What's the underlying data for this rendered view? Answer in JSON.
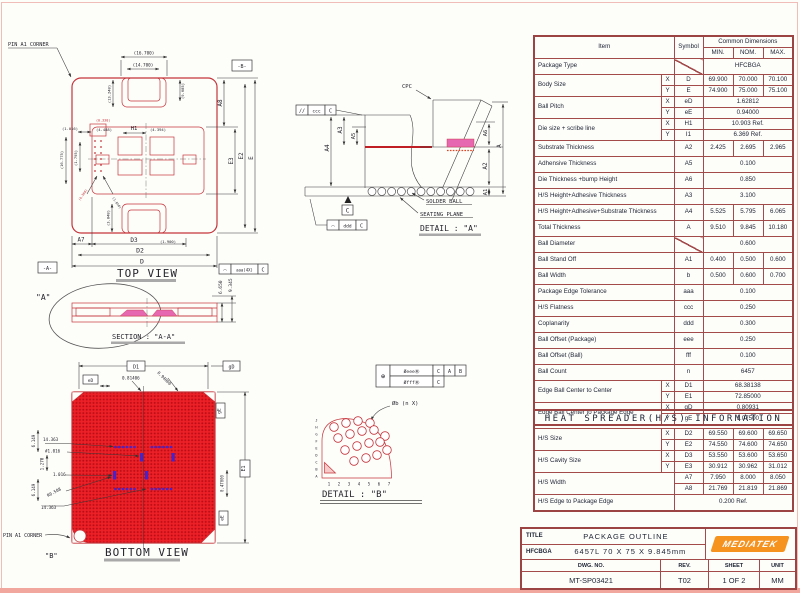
{
  "main_table": {
    "rows": [
      [
        {
          "t": "Item",
          "c": 2,
          "r": 2
        },
        {
          "t": "Symbol",
          "r": 2
        },
        {
          "t": "Common  Dimensions",
          "c": 3
        }
      ],
      [
        {
          "t": "MIN."
        },
        {
          "t": "NOM."
        },
        {
          "t": "MAX."
        }
      ],
      [
        {
          "t": "Package Type",
          "c": 2,
          "cls": "l s"
        },
        {
          "t": "",
          "cls": "diag"
        },
        {
          "t": "HFCBGA",
          "c": 3
        }
      ],
      [
        {
          "t": "Body Size",
          "c": 1,
          "r": 2,
          "cls": "l"
        },
        {
          "t": "X"
        },
        {
          "t": "D"
        },
        {
          "t": "69.900"
        },
        {
          "t": "70.000"
        },
        {
          "t": "70.100"
        }
      ],
      [
        {
          "t": "Y"
        },
        {
          "t": "E"
        },
        {
          "t": "74.900"
        },
        {
          "t": "75.000"
        },
        {
          "t": "75.100"
        }
      ],
      [
        {
          "t": "Ball Pitch",
          "r": 2,
          "cls": "l"
        },
        {
          "t": "X"
        },
        {
          "t": "eD"
        },
        {
          "t": "1.62812",
          "c": 3
        }
      ],
      [
        {
          "t": "Y"
        },
        {
          "t": "eE"
        },
        {
          "t": "0.94000",
          "c": 3
        }
      ],
      [
        {
          "t": "Die size + scribe line",
          "r": 2,
          "cls": "l"
        },
        {
          "t": "X"
        },
        {
          "t": "H1"
        },
        {
          "t": "10.903 Ref.",
          "c": 3
        }
      ],
      [
        {
          "t": "Y"
        },
        {
          "t": "I1"
        },
        {
          "t": "6.369 Ref.",
          "c": 3
        }
      ],
      [
        {
          "t": "Substrate Thickness",
          "c": 2,
          "cls": "l s"
        },
        {
          "t": "A2"
        },
        {
          "t": "2.425"
        },
        {
          "t": "2.695"
        },
        {
          "t": "2.965"
        }
      ],
      [
        {
          "t": "Adhensive Thickness",
          "c": 2,
          "cls": "l s"
        },
        {
          "t": "A5"
        },
        {
          "t": "0.100",
          "c": 3
        }
      ],
      [
        {
          "t": "Die Thickness +bump Height",
          "c": 2,
          "cls": "l s"
        },
        {
          "t": "A6"
        },
        {
          "t": "0.850",
          "c": 3
        }
      ],
      [
        {
          "t": "H/S Height+Adhesive Thickness",
          "c": 2,
          "cls": "l s"
        },
        {
          "t": "A3"
        },
        {
          "t": "3.100",
          "c": 3
        }
      ],
      [
        {
          "t": "H/S Height+Adhesive+Substrate Thickness",
          "c": 2,
          "cls": "l s"
        },
        {
          "t": "A4"
        },
        {
          "t": "5.525"
        },
        {
          "t": "5.795"
        },
        {
          "t": "6.065"
        }
      ],
      [
        {
          "t": "Total Thickness",
          "c": 2,
          "cls": "l s"
        },
        {
          "t": "A"
        },
        {
          "t": "9.510"
        },
        {
          "t": "9.845"
        },
        {
          "t": "10.180"
        }
      ],
      [
        {
          "t": "Ball Diameter",
          "c": 2,
          "cls": "l s"
        },
        {
          "t": "",
          "cls": "diag"
        },
        {
          "t": "0.600",
          "c": 3
        }
      ],
      [
        {
          "t": "Ball Stand Off",
          "c": 2,
          "cls": "l s"
        },
        {
          "t": "A1"
        },
        {
          "t": "0.400"
        },
        {
          "t": "0.500"
        },
        {
          "t": "0.600"
        }
      ],
      [
        {
          "t": "Ball Width",
          "c": 2,
          "cls": "l s"
        },
        {
          "t": "b"
        },
        {
          "t": "0.500"
        },
        {
          "t": "0.600"
        },
        {
          "t": "0.700"
        }
      ],
      [
        {
          "t": "Package Edge Tolerance",
          "c": 2,
          "cls": "l s"
        },
        {
          "t": "aaa"
        },
        {
          "t": "0.100",
          "c": 3
        }
      ],
      [
        {
          "t": "H/S Flatness",
          "c": 2,
          "cls": "l s"
        },
        {
          "t": "ccc"
        },
        {
          "t": "0.250",
          "c": 3
        }
      ],
      [
        {
          "t": "Coplanarity",
          "c": 2,
          "cls": "l s"
        },
        {
          "t": "ddd"
        },
        {
          "t": "0.300",
          "c": 3
        }
      ],
      [
        {
          "t": "Ball Offset (Package)",
          "c": 2,
          "cls": "l s"
        },
        {
          "t": "eee"
        },
        {
          "t": "0.250",
          "c": 3
        }
      ],
      [
        {
          "t": "Ball Offset (Ball)",
          "c": 2,
          "cls": "l s"
        },
        {
          "t": "fff"
        },
        {
          "t": "0.100",
          "c": 3
        }
      ],
      [
        {
          "t": "Ball Count",
          "c": 2,
          "cls": "l s"
        },
        {
          "t": "n"
        },
        {
          "t": "6457",
          "c": 3
        }
      ],
      [
        {
          "t": "Edge Ball Center to Center",
          "r": 2,
          "cls": "l"
        },
        {
          "t": "X"
        },
        {
          "t": "D1"
        },
        {
          "t": "68.38138",
          "c": 3
        }
      ],
      [
        {
          "t": "Y"
        },
        {
          "t": "E1"
        },
        {
          "t": "72.85000",
          "c": 3
        }
      ],
      [
        {
          "t": "Edge Ball Center to Package Edge",
          "r": 2,
          "cls": "l"
        },
        {
          "t": "X"
        },
        {
          "t": "gD"
        },
        {
          "t": "0.80931",
          "c": 3
        }
      ],
      [
        {
          "t": "Y"
        },
        {
          "t": "gE"
        },
        {
          "t": "1.07500",
          "c": 3
        }
      ]
    ]
  },
  "hs_table": {
    "rows": [
      [
        {
          "t": "HEAT SPREADER(H/S) INFORMATION",
          "c": 6,
          "cls": "hst"
        }
      ],
      [
        {
          "t": "H/S Size",
          "r": 2,
          "cls": "l"
        },
        {
          "t": "X"
        },
        {
          "t": "D2"
        },
        {
          "t": "69.550"
        },
        {
          "t": "69.600"
        },
        {
          "t": "69.650"
        }
      ],
      [
        {
          "t": "Y"
        },
        {
          "t": "E2"
        },
        {
          "t": "74.550"
        },
        {
          "t": "74.600"
        },
        {
          "t": "74.650"
        }
      ],
      [
        {
          "t": "H/S Cavity Size",
          "r": 2,
          "cls": "l"
        },
        {
          "t": "X"
        },
        {
          "t": "D3"
        },
        {
          "t": "53.550"
        },
        {
          "t": "53.600"
        },
        {
          "t": "53.650"
        }
      ],
      [
        {
          "t": "Y"
        },
        {
          "t": "E3"
        },
        {
          "t": "30.912"
        },
        {
          "t": "30.962"
        },
        {
          "t": "31.012"
        }
      ],
      [
        {
          "t": "H/S Width",
          "r": 2,
          "c": 2,
          "cls": "l"
        },
        {
          "t": "A7"
        },
        {
          "t": "7.950"
        },
        {
          "t": "8.000"
        },
        {
          "t": "8.050"
        }
      ],
      [
        {
          "t": "A8"
        },
        {
          "t": "21.769"
        },
        {
          "t": "21.819"
        },
        {
          "t": "21.869"
        }
      ],
      [
        {
          "t": "H/S Edge to Package Edge",
          "c": 2,
          "cls": "l s"
        },
        {
          "t": "0.200 Ref.",
          "c": 4
        }
      ]
    ]
  },
  "title_block": {
    "title_label": "TITLE",
    "title": "PACKAGE OUTLINE",
    "pkg": "HFCBGA",
    "pkg_desc": "6457L  70  X  75 X 9.845mm",
    "logo": "MEDIATEK",
    "dwg_label": "DWG.  NO.",
    "dwg_no": "MT-SP03421",
    "rev_label": "REV.",
    "rev": "T02",
    "sheet_label": "SHEET",
    "sheet": "1  OF  2",
    "unit_label": "UNIT",
    "unit": "MM"
  },
  "top_view": {
    "title": "TOP VIEW",
    "pin_label": "PIN A1 CORNER",
    "datum_a": "-A-",
    "datum_b": "-B-",
    "dim_16_7": "(16.700)",
    "dim_14_7": "(14.700)",
    "dim_13_2": "(13.248)",
    "dim_9_68": "(9.685)",
    "h1": "H1",
    "dim_4_488": "(4.488)",
    "dim_4_394": "(4.394)",
    "dim_0_330": "(0.330)",
    "dim_1_016": "(1.016)",
    "dim_1_795": "(1.795)",
    "dim_16_775": "(16.775)",
    "dim_0_508": "(0.508)",
    "dim_1_016b": "(1.016)",
    "a7": "A7",
    "d3": "D3",
    "dim_1_9": "(1.900)",
    "d2": "D2",
    "d": "D",
    "dim_3_848": "(3.848)",
    "a8": "A8",
    "e3": "E3",
    "e2": "E2",
    "e": "E",
    "fcf_sym": "◠",
    "fcf_tol": "aaa(4X)",
    "fcf_datum": "C"
  },
  "section_aa": {
    "callout": "\"A\"",
    "title": "SECTION : \"A-A\"",
    "dim_6_65": "6.650",
    "dim_9_345": "9.345"
  },
  "detail_a": {
    "cpc": "CPC",
    "ccc_sym": "//",
    "ccc_tol": "ccc",
    "ccc_datum": "C",
    "ddd_sym": "◠",
    "ddd_tol": "ddd",
    "ddd_datum": "C",
    "datum_c": "C",
    "a4": "A4",
    "a3": "A3",
    "a5": "A5",
    "a6": "A6",
    "a": "A",
    "a2": "A2",
    "a1": "A1",
    "solder": "SOLDER BALL",
    "seating": "SEATING PLANE",
    "title": "DETAIL : \"A\""
  },
  "bottom_view": {
    "title": "BOTTOM VIEW",
    "pin_label": "PIN A1 CORNER",
    "b_callout": "\"B\"",
    "ed": "eD",
    "d1": "D1",
    "gd": "gD",
    "ge": "gE",
    "ee": "eE",
    "e1": "E1",
    "dim_081406": "0.81406",
    "dim_094": "0.94000",
    "dim_047": "0.47000",
    "dim_14363_t": "14.363",
    "dim_6149_t": "6.149",
    "dim_1016h": "#1.016",
    "dim_1270": "1.270",
    "dim_1016": "1.016",
    "r0508": "R0.508",
    "dim_14363_b": "14.363",
    "dim_6149_b": "6.149"
  },
  "detail_b": {
    "fcf_pos": "⊕",
    "fcf_eee": "ØeeeⓂ",
    "fcf_c1": "C",
    "fcf_a": "A",
    "fcf_b": "B",
    "fcf_fff": "ØfffⓂ",
    "fcf_c2": "C",
    "ball_label": "Øb (n X)",
    "letters": [
      "J",
      "H",
      "G",
      "F",
      "E",
      "D",
      "C",
      "B",
      "A"
    ],
    "numbers": [
      "1",
      "2",
      "3",
      "4",
      "5",
      "6",
      "7"
    ],
    "title": "DETAIL : \"B\""
  }
}
